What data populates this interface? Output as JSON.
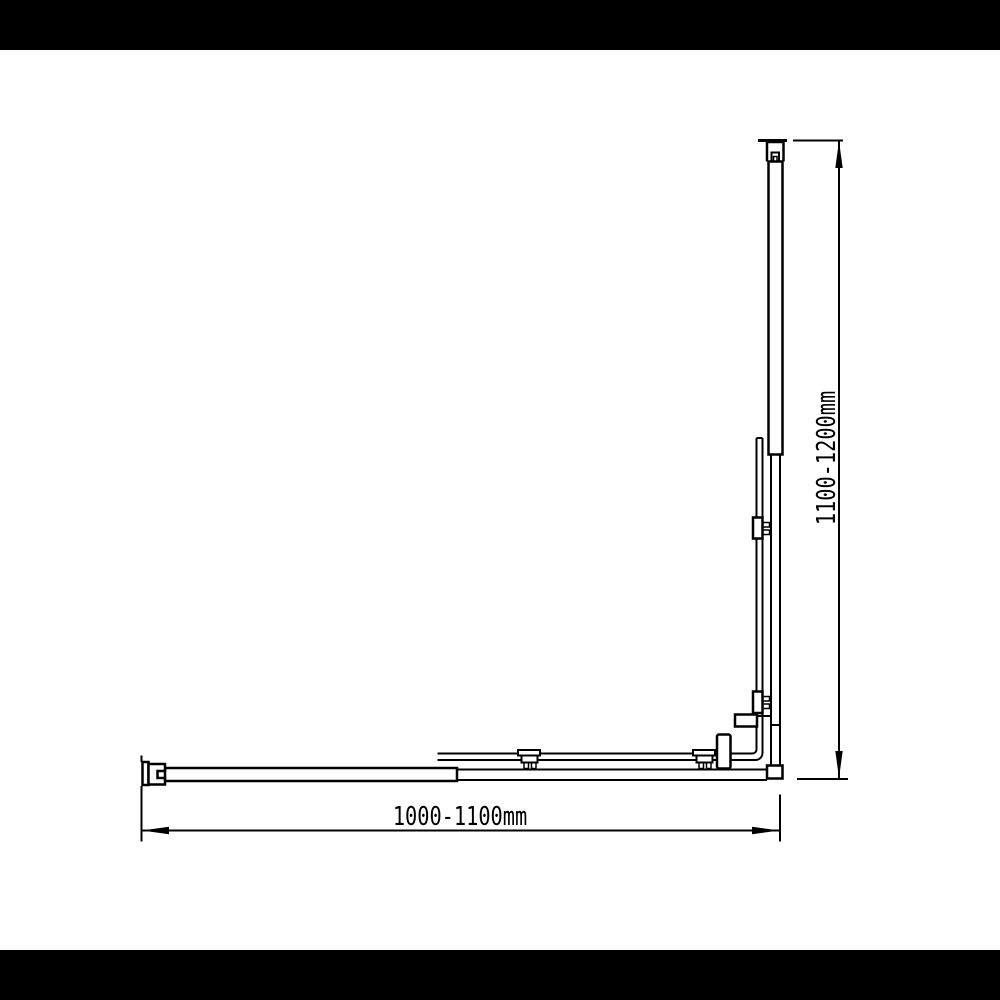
{
  "canvas": {
    "background_color": "#ffffff",
    "letterbox_color": "#000000",
    "line_color": "#000000"
  },
  "diagram": {
    "width_label": "1000-1100mm",
    "height_label": "1100-1200mm",
    "parts": [
      "top-wall-bracket",
      "vertical-support-bar",
      "vertical-wall-profile",
      "vertical-glass-panel",
      "upper-glass-clamp",
      "lower-glass-clamp",
      "hinge-block",
      "corner-post-block",
      "corner-connector-block",
      "bottom-rail",
      "horizontal-support-bar",
      "left-wall-bracket",
      "horizontal-glass-panel",
      "left-roller-bracket",
      "right-roller-bracket",
      "height-dimension-line",
      "width-dimension-line"
    ]
  }
}
